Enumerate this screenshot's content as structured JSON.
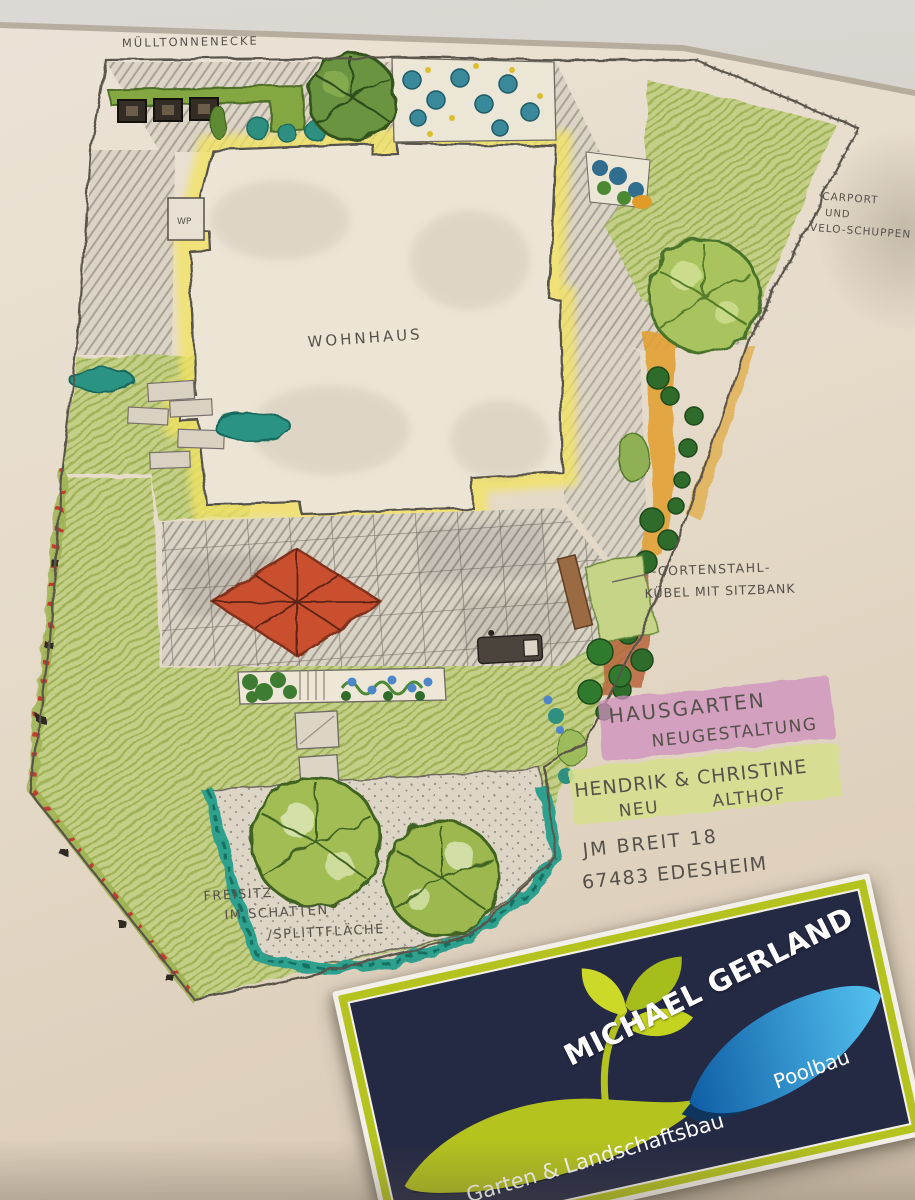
{
  "photo": {
    "background_color": "#d3cfc8",
    "paper_color": "#e7dccb"
  },
  "plan": {
    "labels": {
      "muelltonnenecke": "MÜLLTONNENECKE",
      "wohnhaus": "WOHNHAUS",
      "wp": "WP",
      "carport_1": "CARPORT",
      "carport_2": "UND",
      "carport_3": "VELO-SCHUPPEN",
      "corten_1": "-CORTENSTAHL-",
      "corten_2": "KÜBEL MIT SITZBANK",
      "freisitz_1": "FREISITZ",
      "freisitz_2": "IM SCHATTEN",
      "freisitz_3": "/SPLITTFLÄCHE"
    },
    "title_block": {
      "project_1": "HAUSGARTEN",
      "project_2": "NEUGESTALTUNG",
      "clients_1": "HENDRIK & CHRISTINE",
      "clients_2a": "NEU",
      "clients_2b": "ALTHOF",
      "street": "JM BREIT 18",
      "city": "67483 EDESHEIM"
    },
    "colors": {
      "lawn": "#bcc97c",
      "umbrella_red": "#c9502f",
      "teal_hedge": "#2fa18e",
      "house_halo": "#f2e364",
      "highlight_pink": "#cf8fbe",
      "highlight_green": "#d6df90",
      "mulch_orange": "#e2a136"
    }
  },
  "business_card": {
    "name": "MICHAEL GERLAND",
    "service_left": "Garten & Landschaftsbau",
    "service_right": "Poolbau",
    "colors": {
      "navy": "#242944",
      "lime": "#b5c31f",
      "blue_light": "#54c2f0",
      "blue_dark": "#0f5ea5"
    }
  }
}
